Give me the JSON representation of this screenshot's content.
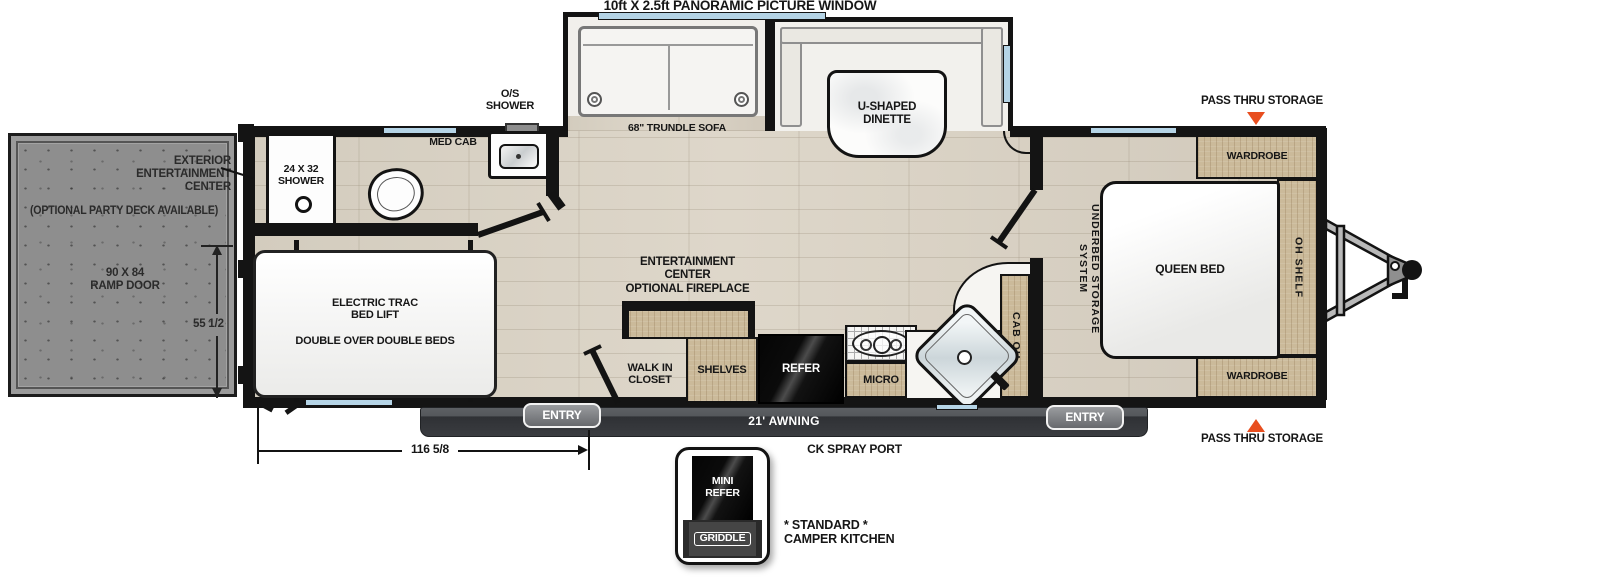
{
  "title": "10ft X 2.5ft PANORAMIC PICTURE WINDOW",
  "colors": {
    "wall": "#141414",
    "accent_orange": "#e84e1f",
    "window_blue": "#b5d4e6",
    "floor_wood": "#d7d0c3",
    "cabinet_wood": "#cbba9a",
    "ramp_gray": "#8e8e8e",
    "awning_dark": "#3a3c40"
  },
  "slideout": {
    "trundle_sofa": "68\" TRUNDLE SOFA",
    "dinette": "U-SHAPED\nDINETTE"
  },
  "bathroom": {
    "shower": "24 X 32\nSHOWER",
    "os_shower": "O/S\nSHOWER",
    "med_cab": "MED CAB"
  },
  "ramp": {
    "exterior_ec": "EXTERIOR\nENTERTAINMENT\nCENTER",
    "party_deck": "(OPTIONAL PARTY DECK AVAILABLE)",
    "ramp_door": "90 X 84\nRAMP DOOR",
    "height_dim": "55 1/2"
  },
  "bunk": {
    "bed_lift": "ELECTRIC TRAC\nBED LIFT",
    "beds": "DOUBLE OVER DOUBLE BEDS"
  },
  "living": {
    "entertainment": "ENTERTAINMENT\nCENTER",
    "fireplace": "OPTIONAL FIREPLACE",
    "walk_in": "WALK IN\nCLOSET",
    "shelves": "SHELVES",
    "refer": "REFER",
    "micro": "MICRO",
    "cab_oh": "CAB OH"
  },
  "bedroom": {
    "underbed": "UNDERBED STORAGE SYSTEM",
    "queen": "QUEEN BED",
    "oh_shelf": "OH SHELF",
    "wardrobe_top": "WARDROBE",
    "wardrobe_bottom": "WARDROBE",
    "pass_thru_top": "PASS THRU STORAGE",
    "pass_thru_bottom": "PASS THRU STORAGE"
  },
  "exterior": {
    "entry_left": "ENTRY",
    "entry_right": "ENTRY",
    "awning": "21' AWNING",
    "length_dim": "116 5/8",
    "ck_spray": "CK SPRAY PORT",
    "std_kitchen": "* STANDARD *\nCAMPER KITCHEN",
    "mini_refer": "MINI\nREFER",
    "griddle": "GRIDDLE"
  }
}
